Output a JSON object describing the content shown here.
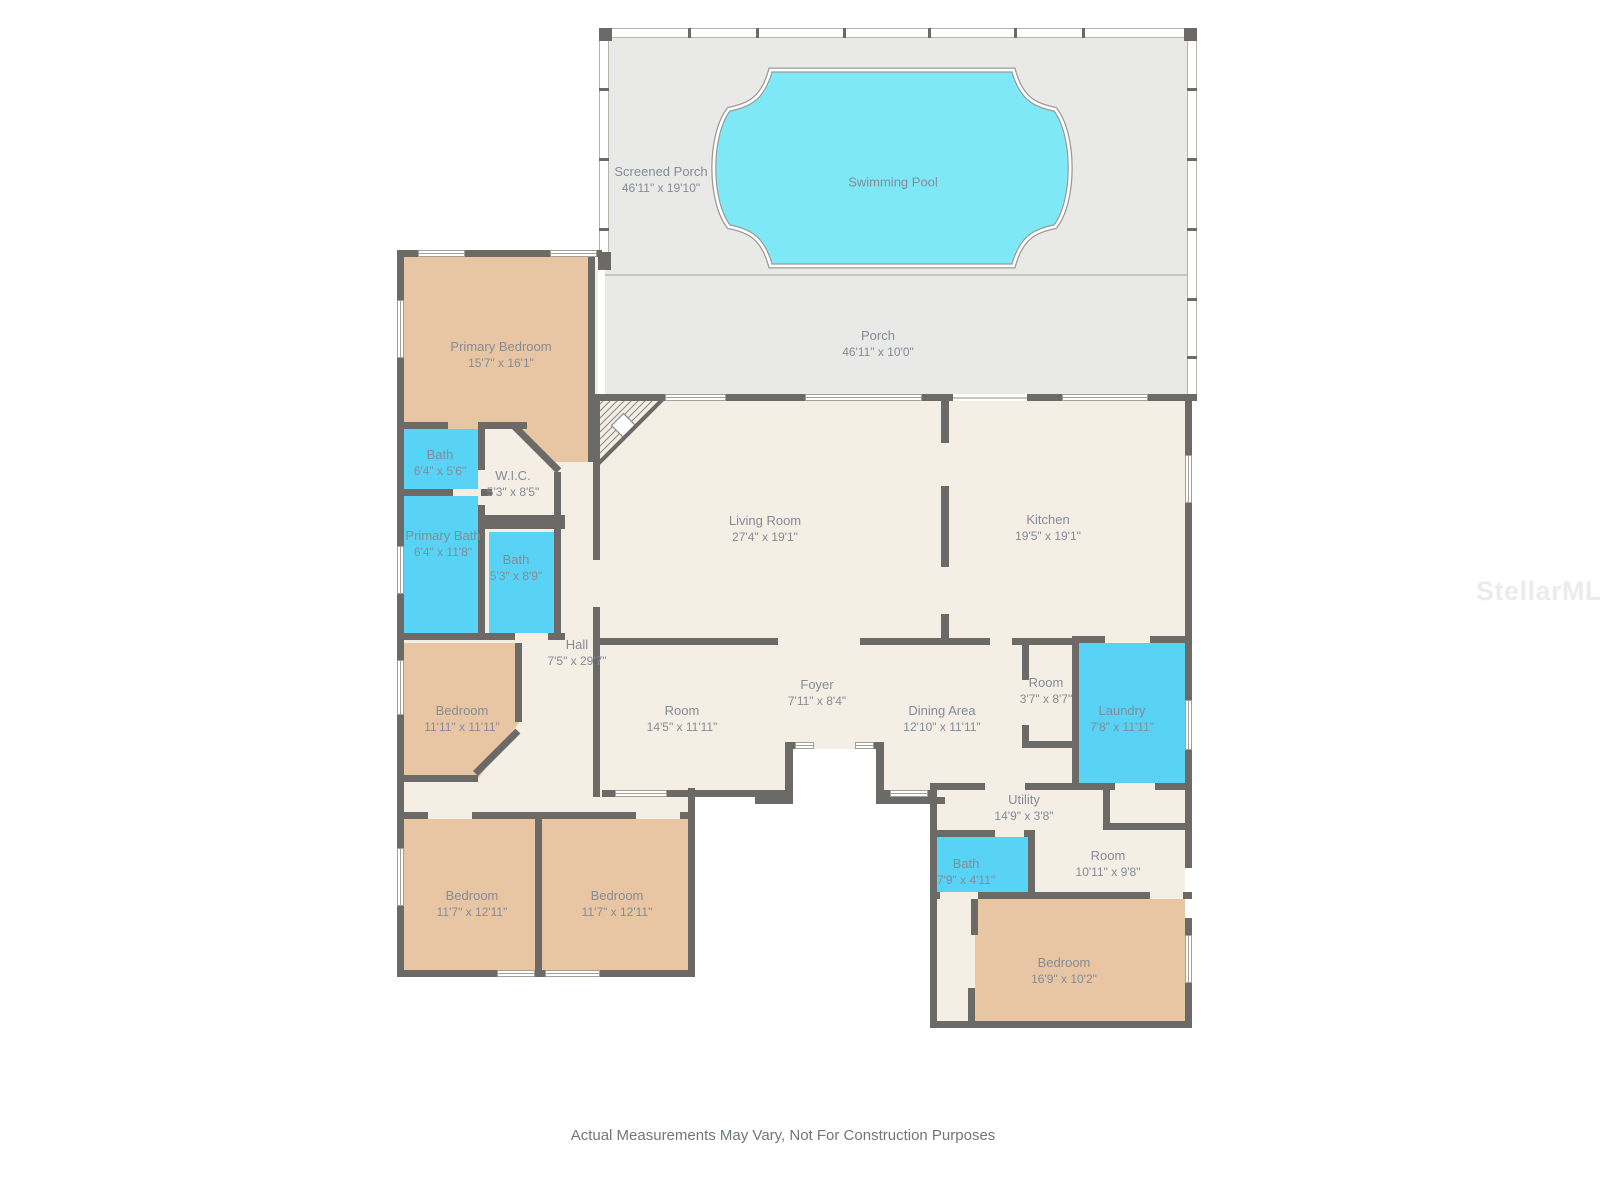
{
  "rooms": [
    {
      "id": "screened-porch",
      "name": "Screened Porch",
      "dims": "46'11\" x 19'10\""
    },
    {
      "id": "swimming-pool",
      "name": "Swimming Pool",
      "dims": ""
    },
    {
      "id": "porch",
      "name": "Porch",
      "dims": "46'11\" x 10'0\""
    },
    {
      "id": "primary-bedroom",
      "name": "Primary Bedroom",
      "dims": "15'7\" x 16'1\""
    },
    {
      "id": "bath-1",
      "name": "Bath",
      "dims": "6'4\" x 5'6\""
    },
    {
      "id": "wic",
      "name": "W.I.C.",
      "dims": "5'3\" x 8'5\""
    },
    {
      "id": "primary-bath",
      "name": "Primary Bath",
      "dims": "6'4\" x 11'8\""
    },
    {
      "id": "bath-2",
      "name": "Bath",
      "dims": "5'3\" x 8'9\""
    },
    {
      "id": "living-room",
      "name": "Living Room",
      "dims": "27'4\" x 19'1\""
    },
    {
      "id": "kitchen",
      "name": "Kitchen",
      "dims": "19'5\" x 19'1\""
    },
    {
      "id": "hall",
      "name": "Hall",
      "dims": "7'5\" x 29'7\""
    },
    {
      "id": "bedroom-middle",
      "name": "Bedroom",
      "dims": "11'11\" x 11'11\""
    },
    {
      "id": "room-1",
      "name": "Room",
      "dims": "14'5\" x 11'11\""
    },
    {
      "id": "foyer",
      "name": "Foyer",
      "dims": "7'11\" x 8'4\""
    },
    {
      "id": "dining-area",
      "name": "Dining Area",
      "dims": "12'10\" x 11'11\""
    },
    {
      "id": "room-2",
      "name": "Room",
      "dims": "3'7\" x 8'7\""
    },
    {
      "id": "laundry",
      "name": "Laundry",
      "dims": "7'8\" x 11'11\""
    },
    {
      "id": "utility",
      "name": "Utility",
      "dims": "14'9\" x 3'8\""
    },
    {
      "id": "bath-3",
      "name": "Bath",
      "dims": "7'9\" x 4'11\""
    },
    {
      "id": "room-3",
      "name": "Room",
      "dims": "10'11\" x 9'8\""
    },
    {
      "id": "bedroom-bottom-left",
      "name": "Bedroom",
      "dims": "11'7\" x 12'11\""
    },
    {
      "id": "bedroom-bottom-right",
      "name": "Bedroom",
      "dims": "11'7\" x 12'11\""
    },
    {
      "id": "bedroom-se",
      "name": "Bedroom",
      "dims": "16'9\" x 10'2\""
    }
  ],
  "watermark": {
    "text": "StellarMLS"
  },
  "footer": {
    "disclaimer": "Actual Measurements May Vary, Not For Construction Purposes"
  },
  "colors": {
    "wall": "#6b6a67",
    "floor_cream": "#f4eee5",
    "bedroom_tan": "#e9c6a3",
    "bath_cyan": "#58d3f5",
    "pool_water": "#7fe8f7",
    "porch_gray": "#e9e9e8",
    "label_text": "#858c96"
  }
}
